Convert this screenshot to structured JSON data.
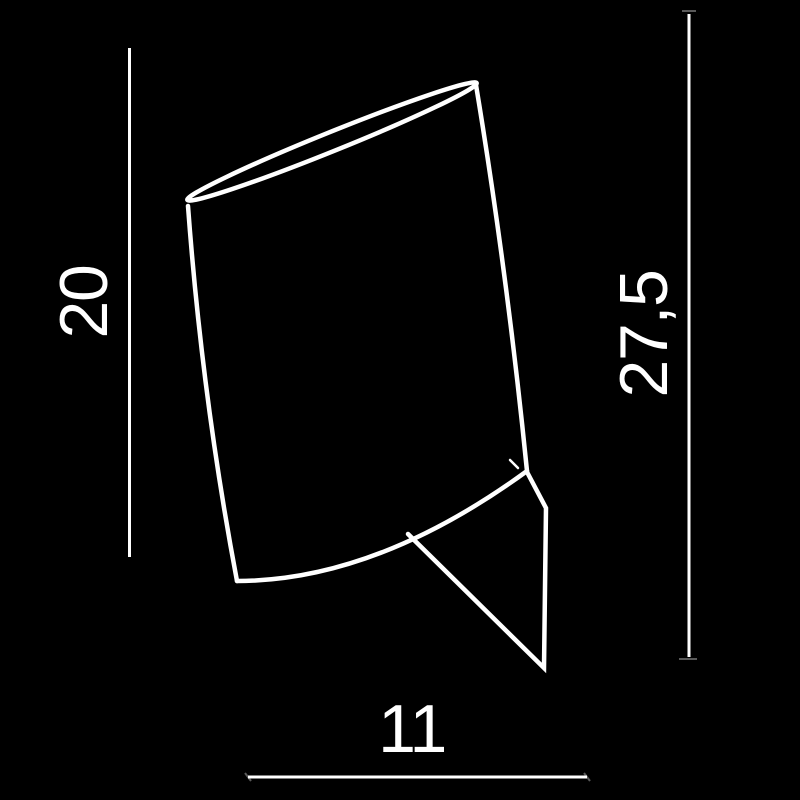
{
  "diagram": {
    "type": "product-dimension-drawing",
    "subject": "tilted cylindrical lamp shade with triangular wall bracket",
    "background_color": "#000000",
    "line_color": "#ffffff",
    "labels": {
      "shade_height": "20",
      "overall_height": "27,5",
      "base_width": "11"
    },
    "dimensions": [
      {
        "name": "shade-height",
        "value": "20",
        "orientation": "vertical",
        "side": "left"
      },
      {
        "name": "overall-height",
        "value": "27,5",
        "orientation": "vertical",
        "side": "right"
      },
      {
        "name": "base-width",
        "value": "11",
        "orientation": "horizontal",
        "side": "bottom"
      }
    ]
  }
}
